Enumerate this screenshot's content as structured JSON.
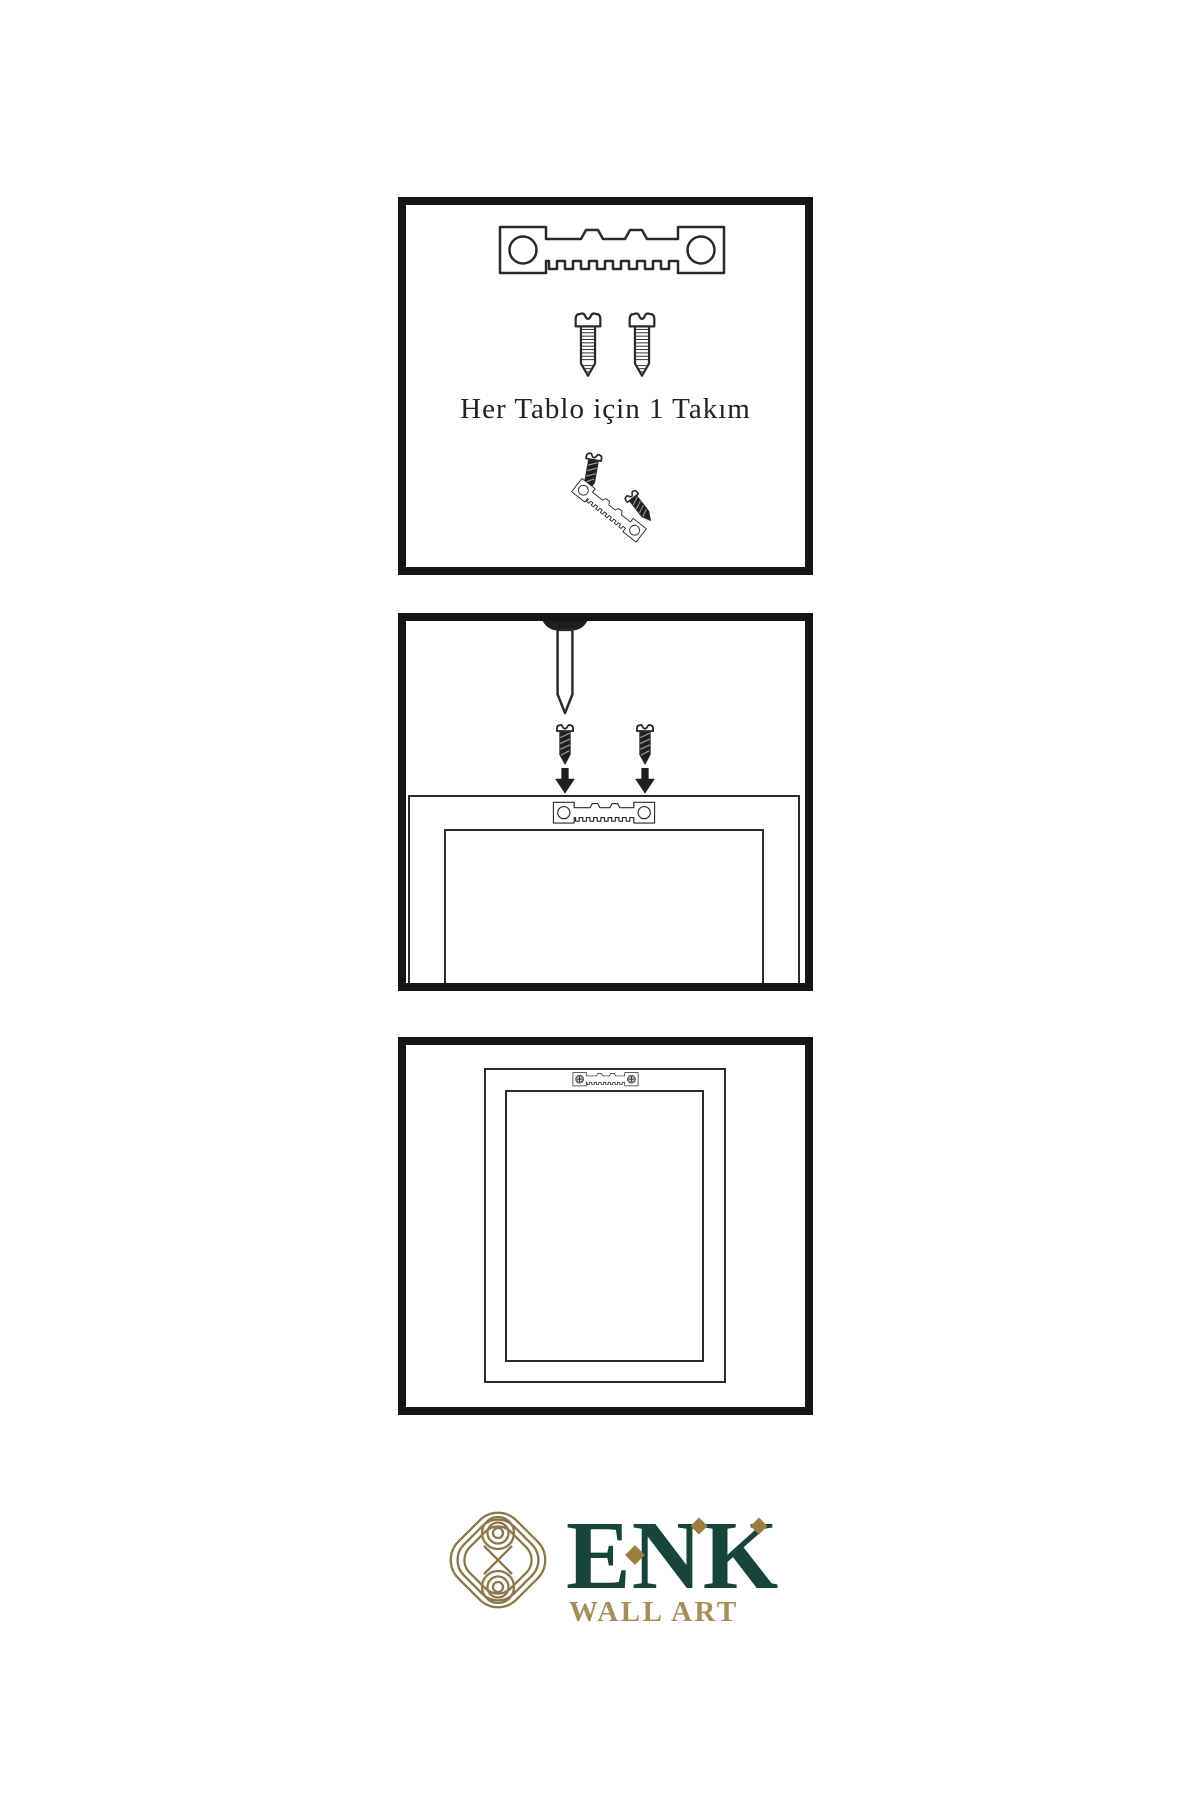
{
  "theme": {
    "green": "#17453a",
    "gold": "#a58e5c",
    "icon_gold": "#8a784a",
    "diamond_gold": "#9a7d3f",
    "stroke": "#2a2a2a",
    "dark": "#1f1f1f",
    "panel_border": "#151515"
  },
  "steps": [
    {
      "id": "hardware-kit",
      "caption": "Her Tablo için 1 Takım"
    },
    {
      "id": "wall-mounting",
      "caption": ""
    },
    {
      "id": "hung-frame",
      "caption": ""
    }
  ],
  "brand": {
    "name": "ENK",
    "tagline": "WALL ART"
  }
}
